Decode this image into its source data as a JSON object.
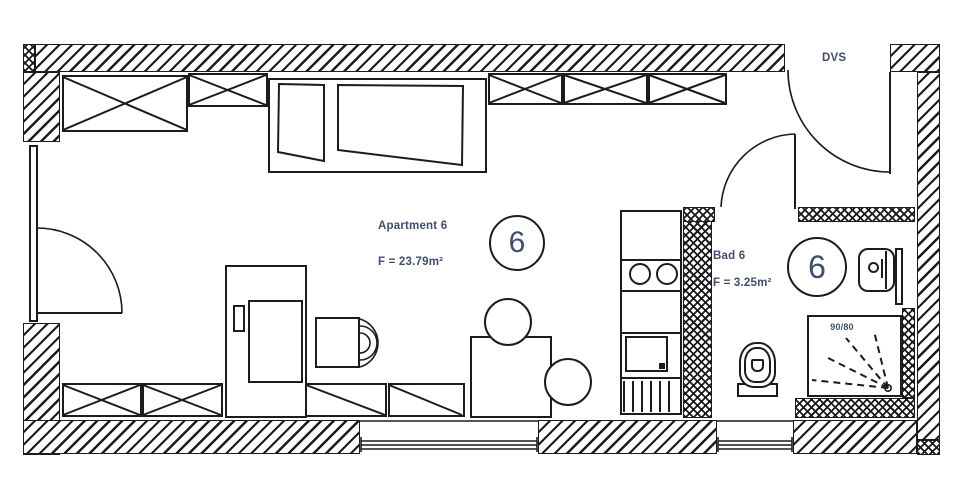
{
  "plan": {
    "apartment": {
      "name": "Apartment 6",
      "area": "F = 23.79m²",
      "number": "6"
    },
    "bathroom": {
      "name": "Bad 6",
      "area": "F = 3.25m²",
      "number": "6"
    },
    "corridor_label": "DVS",
    "shower_size_label": "90/80",
    "colors": {
      "ink": "#1c1c1c",
      "label": "#3f4d6e",
      "paper": "#ffffff"
    }
  }
}
